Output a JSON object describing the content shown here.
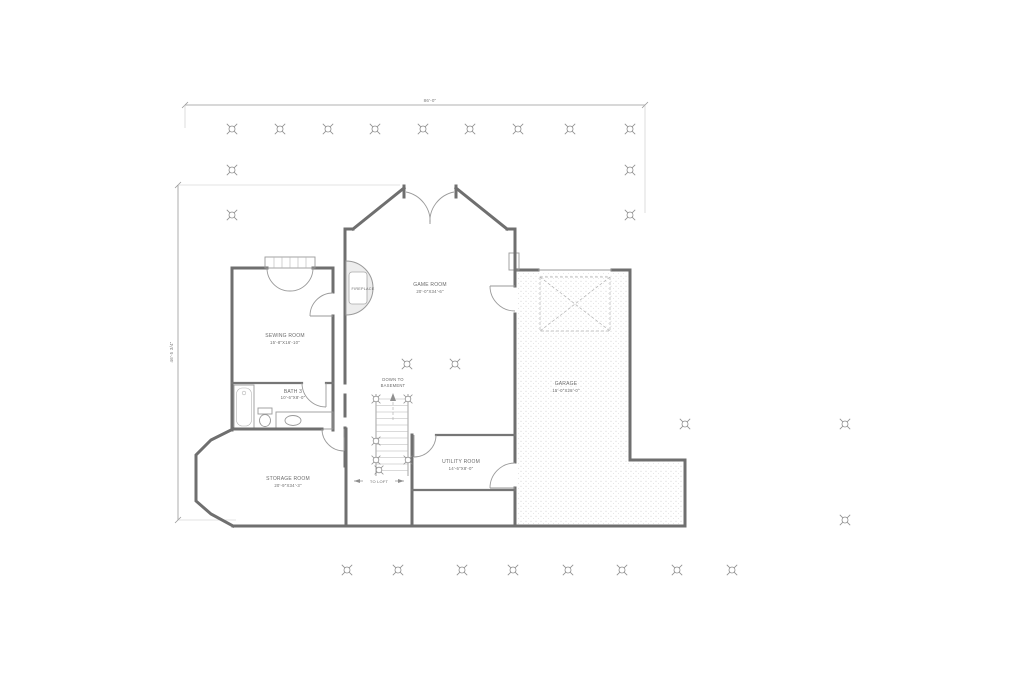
{
  "drawing": {
    "type": "architectural-floor-plan",
    "colors": {
      "background": "#ffffff",
      "walls": "#6f6f6f",
      "thin_lines": "#9a9a9a",
      "text": "#6b6b6b",
      "garage_stipple": "#bdbdbd",
      "fireplace_fill": "#ededed"
    },
    "dimensions": {
      "top_overall": "86'-0\"",
      "left_overall": "46'-5 3/4\""
    },
    "rooms": [
      {
        "label": "GAME ROOM",
        "size": "20'-0\"X34'-6\""
      },
      {
        "label": "SEWING ROOM",
        "size": "15'-8\"X16'-10\""
      },
      {
        "label": "BATH 3",
        "size": "10'-6\"X8'-0\""
      },
      {
        "label": "STORAGE ROOM",
        "size": "20'-9\"X34'-3\""
      },
      {
        "label": "UTILITY ROOM",
        "size": "14'-6\"X8'-0\""
      },
      {
        "label": "GARAGE",
        "size": "15'-0\"X28'-0\""
      }
    ],
    "annotations": {
      "fireplace": "FIREPLACE",
      "stairs_down_line1": "DOWN TO",
      "stairs_down_line2": "BASEMENT",
      "to_loft": "TO LOFT"
    },
    "symbols": {
      "grid_marker": "survey-target-marker",
      "stair_post": "post-marker",
      "attic_brace": "dashed-x-brace"
    }
  }
}
